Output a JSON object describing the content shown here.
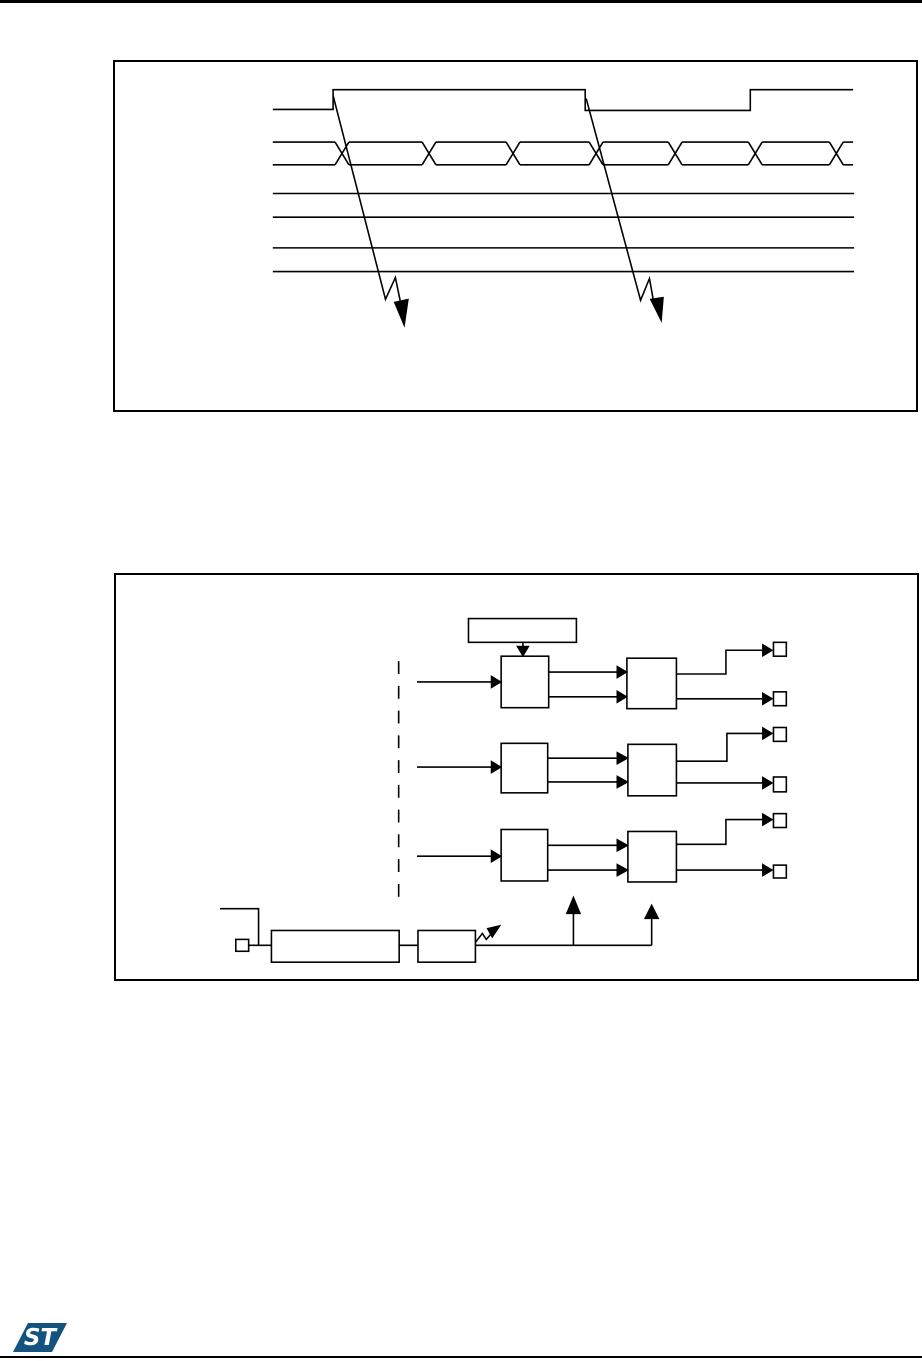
{
  "colors": {
    "background": "#ffffff",
    "line": "#000000"
  },
  "logo": {
    "text": "ST",
    "color": "#14537f"
  },
  "figures": {
    "timing-diagram": {
      "x": 113,
      "y": 60,
      "width": 805,
      "height": 352,
      "primitives": [
        {
          "t": "pl",
          "p": "157,48 218,48 218,28 473,28 473,49 640,49 640,28 744,28",
          "name": "enable-signal-waveform"
        },
        {
          "t": "l",
          "x1": 157,
          "y1": 81,
          "x2": 220,
          "y2": 81,
          "name": "bus-top"
        },
        {
          "t": "l",
          "x1": 234,
          "y1": 81,
          "x2": 308,
          "y2": 81
        },
        {
          "t": "l",
          "x1": 322,
          "y1": 81,
          "x2": 393,
          "y2": 81
        },
        {
          "t": "l",
          "x1": 407,
          "y1": 81,
          "x2": 477,
          "y2": 81
        },
        {
          "t": "l",
          "x1": 491,
          "y1": 81,
          "x2": 557,
          "y2": 81
        },
        {
          "t": "l",
          "x1": 571,
          "y1": 81,
          "x2": 638,
          "y2": 81
        },
        {
          "t": "l",
          "x1": 652,
          "y1": 81,
          "x2": 720,
          "y2": 81
        },
        {
          "t": "l",
          "x1": 734,
          "y1": 81,
          "x2": 744,
          "y2": 81
        },
        {
          "t": "l",
          "x1": 157,
          "y1": 104,
          "x2": 220,
          "y2": 104,
          "name": "bus-bottom"
        },
        {
          "t": "l",
          "x1": 234,
          "y1": 104,
          "x2": 308,
          "y2": 104
        },
        {
          "t": "l",
          "x1": 322,
          "y1": 104,
          "x2": 393,
          "y2": 104
        },
        {
          "t": "l",
          "x1": 407,
          "y1": 104,
          "x2": 477,
          "y2": 104
        },
        {
          "t": "l",
          "x1": 491,
          "y1": 104,
          "x2": 557,
          "y2": 104
        },
        {
          "t": "l",
          "x1": 571,
          "y1": 104,
          "x2": 638,
          "y2": 104
        },
        {
          "t": "l",
          "x1": 652,
          "y1": 104,
          "x2": 720,
          "y2": 104
        },
        {
          "t": "l",
          "x1": 734,
          "y1": 104,
          "x2": 744,
          "y2": 104
        },
        {
          "t": "l",
          "x1": 220,
          "y1": 81,
          "x2": 234,
          "y2": 104,
          "name": "bus-crossing"
        },
        {
          "t": "l",
          "x1": 220,
          "y1": 104,
          "x2": 234,
          "y2": 81
        },
        {
          "t": "l",
          "x1": 308,
          "y1": 81,
          "x2": 322,
          "y2": 104,
          "name": "bus-crossing"
        },
        {
          "t": "l",
          "x1": 308,
          "y1": 104,
          "x2": 322,
          "y2": 81
        },
        {
          "t": "l",
          "x1": 393,
          "y1": 81,
          "x2": 407,
          "y2": 104,
          "name": "bus-crossing"
        },
        {
          "t": "l",
          "x1": 393,
          "y1": 104,
          "x2": 407,
          "y2": 81
        },
        {
          "t": "l",
          "x1": 477,
          "y1": 81,
          "x2": 491,
          "y2": 104,
          "name": "bus-crossing"
        },
        {
          "t": "l",
          "x1": 477,
          "y1": 104,
          "x2": 491,
          "y2": 81
        },
        {
          "t": "l",
          "x1": 557,
          "y1": 81,
          "x2": 571,
          "y2": 104,
          "name": "bus-crossing"
        },
        {
          "t": "l",
          "x1": 557,
          "y1": 104,
          "x2": 571,
          "y2": 81
        },
        {
          "t": "l",
          "x1": 638,
          "y1": 81,
          "x2": 652,
          "y2": 104,
          "name": "bus-crossing"
        },
        {
          "t": "l",
          "x1": 638,
          "y1": 104,
          "x2": 652,
          "y2": 81
        },
        {
          "t": "l",
          "x1": 720,
          "y1": 81,
          "x2": 734,
          "y2": 104,
          "name": "bus-crossing"
        },
        {
          "t": "l",
          "x1": 720,
          "y1": 104,
          "x2": 734,
          "y2": 81
        },
        {
          "t": "l",
          "x1": 157,
          "y1": 133,
          "x2": 745,
          "y2": 133,
          "name": "signal-line"
        },
        {
          "t": "l",
          "x1": 157,
          "y1": 157,
          "x2": 745,
          "y2": 157,
          "name": "signal-line"
        },
        {
          "t": "l",
          "x1": 157,
          "y1": 188,
          "x2": 745,
          "y2": 188,
          "name": "signal-line"
        },
        {
          "t": "l",
          "x1": 157,
          "y1": 212,
          "x2": 745,
          "y2": 212,
          "name": "signal-line"
        },
        {
          "t": "pl",
          "p": "218,34 271,240 281,218 287,247",
          "name": "event-arrow-left"
        },
        {
          "t": "f",
          "p": "280,243 294,240 290,267",
          "name": "event-arrowhead-left"
        },
        {
          "t": "pl",
          "p": "474,37 529,241 538,219 543,247",
          "name": "event-arrow-right"
        },
        {
          "t": "f",
          "p": "539,240 552,238 550,262",
          "name": "event-arrowhead-right"
        }
      ]
    },
    "block-diagram": {
      "x": 114,
      "y": 573,
      "width": 805,
      "height": 408,
      "primitives": [
        {
          "t": "r",
          "x": 354,
          "y": 44,
          "w": 109,
          "h": 24,
          "name": "register-block"
        },
        {
          "t": "l",
          "x1": 409,
          "y1": 68,
          "x2": 409,
          "y2": 74
        },
        {
          "t": "f",
          "p": "403,72 415,72 409,82",
          "name": "down-arrowhead"
        },
        {
          "t": "dl",
          "x1": 283.5,
          "y1": 87,
          "x2": 283.5,
          "y2": 325,
          "dash": "13,12",
          "name": "dashed-divider"
        },
        {
          "t": "r",
          "x": 387,
          "y": 82,
          "w": 48,
          "h": 52,
          "name": "stage1-block-a"
        },
        {
          "t": "r",
          "x": 514,
          "y": 84,
          "w": 50,
          "h": 51,
          "name": "stage1-block-b"
        },
        {
          "t": "l",
          "x1": 302,
          "y1": 108,
          "x2": 380,
          "y2": 108
        },
        {
          "t": "f",
          "p": "377,102 377,114 387,108"
        },
        {
          "t": "l",
          "x1": 435,
          "y1": 98,
          "x2": 507,
          "y2": 98
        },
        {
          "t": "f",
          "p": "504,92 504,104 514,98"
        },
        {
          "t": "l",
          "x1": 435,
          "y1": 123,
          "x2": 507,
          "y2": 123
        },
        {
          "t": "f",
          "p": "504,117 504,129 514,123"
        },
        {
          "t": "pl",
          "p": "564,100 614,100 614,76 652,76"
        },
        {
          "t": "f",
          "p": "651,70 651,82 661,76"
        },
        {
          "t": "r",
          "x": 662,
          "y": 68,
          "w": 13,
          "h": 14,
          "name": "output-pad"
        },
        {
          "t": "l",
          "x1": 564,
          "y1": 125,
          "x2": 652,
          "y2": 125
        },
        {
          "t": "f",
          "p": "651,119 651,131 661,125"
        },
        {
          "t": "r",
          "x": 662,
          "y": 118,
          "w": 13,
          "h": 14,
          "name": "output-pad"
        },
        {
          "t": "r",
          "x": 387,
          "y": 170,
          "w": 47,
          "h": 50,
          "name": "stage2-block-a"
        },
        {
          "t": "r",
          "x": 515,
          "y": 171,
          "w": 49,
          "h": 52,
          "name": "stage2-block-b"
        },
        {
          "t": "l",
          "x1": 302,
          "y1": 194,
          "x2": 380,
          "y2": 194
        },
        {
          "t": "f",
          "p": "377,188 377,200 387,194"
        },
        {
          "t": "l",
          "x1": 434,
          "y1": 185,
          "x2": 507,
          "y2": 185
        },
        {
          "t": "f",
          "p": "504,179 504,191 515,185"
        },
        {
          "t": "l",
          "x1": 434,
          "y1": 209,
          "x2": 507,
          "y2": 209
        },
        {
          "t": "f",
          "p": "504,203 504,215 515,209"
        },
        {
          "t": "pl",
          "p": "564,188 615,188 615,160 652,160"
        },
        {
          "t": "f",
          "p": "651,154 651,166 661,160"
        },
        {
          "t": "r",
          "x": 662,
          "y": 154,
          "w": 13,
          "h": 14,
          "name": "output-pad"
        },
        {
          "t": "l",
          "x1": 564,
          "y1": 210,
          "x2": 652,
          "y2": 210
        },
        {
          "t": "f",
          "p": "651,204 651,216 661,210"
        },
        {
          "t": "r",
          "x": 662,
          "y": 204,
          "w": 13,
          "h": 15,
          "name": "output-pad"
        },
        {
          "t": "r",
          "x": 387,
          "y": 257,
          "w": 47,
          "h": 52,
          "name": "stage3-block-a"
        },
        {
          "t": "r",
          "x": 515,
          "y": 259,
          "w": 49,
          "h": 51,
          "name": "stage3-block-b"
        },
        {
          "t": "l",
          "x1": 302,
          "y1": 284,
          "x2": 380,
          "y2": 284
        },
        {
          "t": "f",
          "p": "377,278 377,290 387,284"
        },
        {
          "t": "l",
          "x1": 434,
          "y1": 273,
          "x2": 507,
          "y2": 273
        },
        {
          "t": "f",
          "p": "504,267 504,279 515,273"
        },
        {
          "t": "l",
          "x1": 434,
          "y1": 298,
          "x2": 507,
          "y2": 298
        },
        {
          "t": "f",
          "p": "504,292 504,304 515,298"
        },
        {
          "t": "pl",
          "p": "564,272 614,272 614,247 652,247"
        },
        {
          "t": "f",
          "p": "651,241 651,253 661,247"
        },
        {
          "t": "r",
          "x": 662,
          "y": 241,
          "w": 13,
          "h": 14,
          "name": "output-pad"
        },
        {
          "t": "l",
          "x1": 564,
          "y1": 298,
          "x2": 652,
          "y2": 298
        },
        {
          "t": "f",
          "p": "651,292 651,304 661,298"
        },
        {
          "t": "r",
          "x": 662,
          "y": 293,
          "w": 13,
          "h": 13,
          "name": "output-pad"
        },
        {
          "t": "pl",
          "p": "103,337 142,337 142,374",
          "name": "input-stub"
        },
        {
          "t": "r",
          "x": 119,
          "y": 368,
          "w": 13,
          "h": 12,
          "name": "input-pad"
        },
        {
          "t": "l",
          "x1": 132,
          "y1": 374,
          "x2": 155,
          "y2": 374
        },
        {
          "t": "r",
          "x": 155,
          "y": 359,
          "w": 129,
          "h": 32,
          "name": "prescaler-block"
        },
        {
          "t": "l",
          "x1": 284,
          "y1": 374,
          "x2": 303,
          "y2": 374
        },
        {
          "t": "r",
          "x": 303,
          "y": 359,
          "w": 58,
          "h": 32,
          "name": "divider-block"
        },
        {
          "t": "pl",
          "p": "361,371 368,362 372,368 378,361",
          "name": "trim-zigzag"
        },
        {
          "t": "f",
          "p": "373,357 378,366 386,354",
          "name": "trim-arrowhead"
        },
        {
          "t": "l",
          "x1": 361,
          "y1": 374,
          "x2": 539,
          "y2": 374,
          "name": "clock-wire"
        },
        {
          "t": "l",
          "x1": 460,
          "y1": 374,
          "x2": 460,
          "y2": 342
        },
        {
          "t": "f",
          "p": "453,342 467,342 460,325",
          "name": "up-arrowhead"
        },
        {
          "t": "l",
          "x1": 539,
          "y1": 374,
          "x2": 539,
          "y2": 347
        },
        {
          "t": "f",
          "p": "532,347 546,347 539,333",
          "name": "up-arrowhead"
        }
      ]
    }
  }
}
